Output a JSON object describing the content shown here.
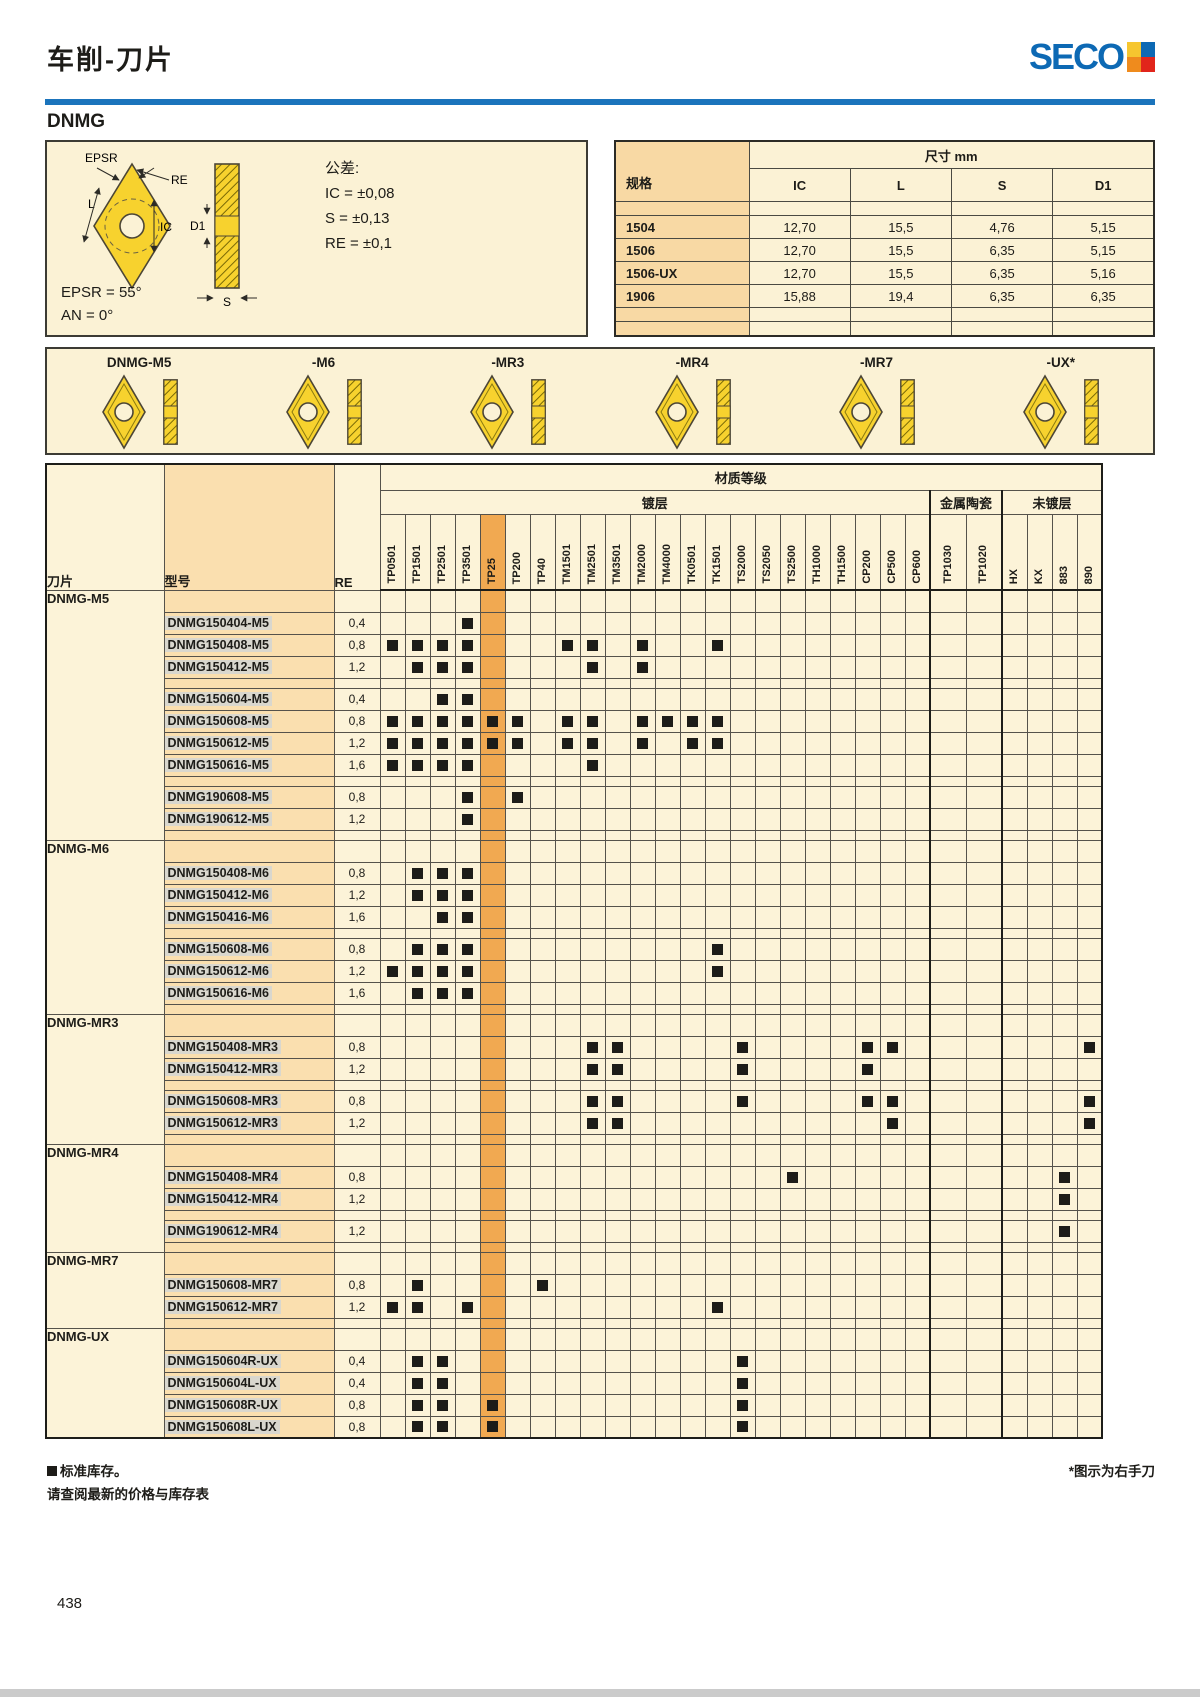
{
  "header": {
    "title": "车削-刀片",
    "brand": "SECO",
    "product": "DNMG"
  },
  "colors": {
    "rule_blue": "#1b74bc",
    "brand_blue": "#0d69b4",
    "panel_bg": "#fbf2d5",
    "label_col_bg": "#fadfaf",
    "highlight_col": "#f1a951",
    "mark": "#1d1c18"
  },
  "info": {
    "tolerance": [
      "公差:",
      "IC = ±0,08",
      "S = ±0,13",
      "RE = ±0,1"
    ],
    "angles": [
      "EPSR = 55°",
      "AN = 0°"
    ]
  },
  "diagram": {
    "labels": {
      "epsr": "EPSR",
      "re": "RE",
      "l": "L",
      "ic": "IC",
      "d1": "D1",
      "s": "S"
    }
  },
  "dimensions": {
    "title": "尺寸 mm",
    "spec_label": "规格",
    "columns": [
      "IC",
      "L",
      "S",
      "D1"
    ],
    "rows": [
      {
        "spec": "",
        "values": [
          "",
          "",
          "",
          ""
        ]
      },
      {
        "spec": "1504",
        "values": [
          "12,70",
          "15,5",
          "4,76",
          "5,15"
        ]
      },
      {
        "spec": "1506",
        "values": [
          "12,70",
          "15,5",
          "6,35",
          "5,15"
        ]
      },
      {
        "spec": "1506-UX",
        "values": [
          "12,70",
          "15,5",
          "6,35",
          "5,16"
        ]
      },
      {
        "spec": "1906",
        "values": [
          "15,88",
          "19,4",
          "6,35",
          "6,35"
        ]
      },
      {
        "spec": "",
        "values": [
          "",
          "",
          "",
          ""
        ]
      },
      {
        "spec": "",
        "values": [
          "",
          "",
          "",
          ""
        ]
      }
    ]
  },
  "inserts": {
    "items": [
      {
        "label": "DNMG-M5"
      },
      {
        "label": "-M6"
      },
      {
        "label": "-MR3"
      },
      {
        "label": "-MR4"
      },
      {
        "label": "-MR7"
      },
      {
        "label": "-UX*"
      }
    ]
  },
  "matrix": {
    "header": {
      "knife": "刀片",
      "model": "型号",
      "re": "RE",
      "material": "材质等级"
    },
    "segments": [
      {
        "label": "镀层",
        "count": 22
      },
      {
        "label": "金属陶瓷",
        "count": 2
      },
      {
        "label": "未镀层",
        "count": 4
      }
    ],
    "highlight": "TP25",
    "columns": [
      "TP0501",
      "TP1501",
      "TP2501",
      "TP3501",
      "TP25",
      "TP200",
      "TP40",
      "TM1501",
      "TM2501",
      "TM3501",
      "TM2000",
      "TM4000",
      "TK0501",
      "TK1501",
      "TS2000",
      "TS2050",
      "TS2500",
      "TH1000",
      "TH1500",
      "CP200",
      "CP500",
      "CP600",
      "TP1030",
      "TP1020",
      "HX",
      "KX",
      "883",
      "890"
    ],
    "groups": [
      {
        "name": "DNMG-M5",
        "rows": [
          "title",
          [
            "DNMG150404-M5",
            "0,4",
            [
              "TP3501"
            ]
          ],
          [
            "DNMG150408-M5",
            "0,8",
            [
              "TP0501",
              "TP1501",
              "TP2501",
              "TP3501",
              "TM1501",
              "TM2501",
              "TM2000",
              "TK1501"
            ]
          ],
          [
            "DNMG150412-M5",
            "1,2",
            [
              "TP1501",
              "TP2501",
              "TP3501",
              "TM2501",
              "TM2000"
            ]
          ],
          "gap",
          [
            "DNMG150604-M5",
            "0,4",
            [
              "TP2501",
              "TP3501"
            ]
          ],
          [
            "DNMG150608-M5",
            "0,8",
            [
              "TP0501",
              "TP1501",
              "TP2501",
              "TP3501",
              "TP25",
              "TP200",
              "TM1501",
              "TM2501",
              "TM2000",
              "TM4000",
              "TK0501",
              "TK1501"
            ]
          ],
          [
            "DNMG150612-M5",
            "1,2",
            [
              "TP0501",
              "TP1501",
              "TP2501",
              "TP3501",
              "TP25",
              "TP200",
              "TM1501",
              "TM2501",
              "TM2000",
              "TK0501",
              "TK1501"
            ]
          ],
          [
            "DNMG150616-M5",
            "1,6",
            [
              "TP0501",
              "TP1501",
              "TP2501",
              "TP3501",
              "TM2501"
            ]
          ],
          "gap",
          [
            "DNMG190608-M5",
            "0,8",
            [
              "TP3501",
              "TP200"
            ]
          ],
          [
            "DNMG190612-M5",
            "1,2",
            [
              "TP3501"
            ]
          ],
          "gap"
        ]
      },
      {
        "name": "DNMG-M6",
        "rows": [
          "title",
          [
            "DNMG150408-M6",
            "0,8",
            [
              "TP1501",
              "TP2501",
              "TP3501"
            ]
          ],
          [
            "DNMG150412-M6",
            "1,2",
            [
              "TP1501",
              "TP2501",
              "TP3501"
            ]
          ],
          [
            "DNMG150416-M6",
            "1,6",
            [
              "TP2501",
              "TP3501"
            ]
          ],
          "gap",
          [
            "DNMG150608-M6",
            "0,8",
            [
              "TP1501",
              "TP2501",
              "TP3501",
              "TK1501"
            ]
          ],
          [
            "DNMG150612-M6",
            "1,2",
            [
              "TP0501",
              "TP1501",
              "TP2501",
              "TP3501",
              "TK1501"
            ]
          ],
          [
            "DNMG150616-M6",
            "1,6",
            [
              "TP1501",
              "TP2501",
              "TP3501"
            ]
          ],
          "gap"
        ]
      },
      {
        "name": "DNMG-MR3",
        "rows": [
          "title",
          [
            "DNMG150408-MR3",
            "0,8",
            [
              "TM2501",
              "TM3501",
              "TS2000",
              "CP200",
              "CP500",
              "890"
            ]
          ],
          [
            "DNMG150412-MR3",
            "1,2",
            [
              "TM2501",
              "TM3501",
              "TS2000",
              "CP200"
            ]
          ],
          "gap",
          [
            "DNMG150608-MR3",
            "0,8",
            [
              "TM2501",
              "TM3501",
              "TS2000",
              "CP200",
              "CP500",
              "890"
            ]
          ],
          [
            "DNMG150612-MR3",
            "1,2",
            [
              "TM2501",
              "TM3501",
              "CP500",
              "890"
            ]
          ],
          "gap"
        ]
      },
      {
        "name": "DNMG-MR4",
        "rows": [
          "title",
          [
            "DNMG150408-MR4",
            "0,8",
            [
              "TS2500",
              "883"
            ]
          ],
          [
            "DNMG150412-MR4",
            "1,2",
            [
              "883"
            ]
          ],
          "gap",
          [
            "DNMG190612-MR4",
            "1,2",
            [
              "883"
            ]
          ],
          "gap"
        ]
      },
      {
        "name": "DNMG-MR7",
        "rows": [
          "title",
          [
            "DNMG150608-MR7",
            "0,8",
            [
              "TP1501",
              "TP40"
            ]
          ],
          [
            "DNMG150612-MR7",
            "1,2",
            [
              "TP0501",
              "TP1501",
              "TP3501",
              "TK1501"
            ]
          ],
          "gap"
        ]
      },
      {
        "name": "DNMG-UX",
        "rows": [
          "title",
          [
            "DNMG150604R-UX",
            "0,4",
            [
              "TP1501",
              "TP2501",
              "TS2000"
            ]
          ],
          [
            "DNMG150604L-UX",
            "0,4",
            [
              "TP1501",
              "TP2501",
              "TS2000"
            ]
          ],
          [
            "DNMG150608R-UX",
            "0,8",
            [
              "TP1501",
              "TP2501",
              "TP25",
              "TS2000"
            ]
          ],
          [
            "DNMG150608L-UX",
            "0,8",
            [
              "TP1501",
              "TP2501",
              "TP25",
              "TS2000"
            ]
          ]
        ]
      }
    ]
  },
  "footer": {
    "stock_note": "标准库存。",
    "price_note": "请查阅最新的价格与库存表",
    "hand_note": "*图示为右手刀",
    "page_number": "438"
  }
}
